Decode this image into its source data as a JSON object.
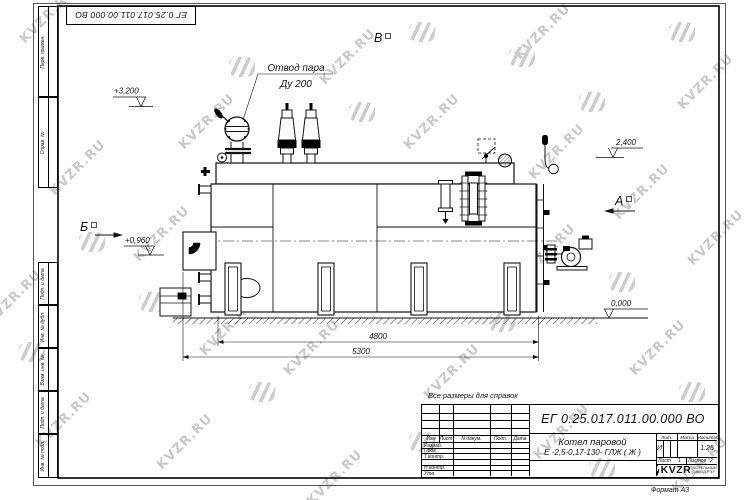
{
  "watermark": {
    "text": "KVZR.RU",
    "text_positions": [
      [
        48,
        16
      ],
      [
        78,
        168
      ],
      [
        14,
        298
      ],
      [
        64,
        420
      ],
      [
        162,
        234
      ],
      [
        207,
        122
      ],
      [
        228,
        328
      ],
      [
        185,
        442
      ],
      [
        302,
        202
      ],
      [
        312,
        348
      ],
      [
        348,
        57
      ],
      [
        335,
        478
      ],
      [
        432,
        122
      ],
      [
        418,
        257
      ],
      [
        452,
        372
      ],
      [
        543,
        32
      ],
      [
        557,
        152
      ],
      [
        548,
        252
      ],
      [
        562,
        432
      ],
      [
        642,
        192
      ],
      [
        658,
        348
      ],
      [
        706,
        82
      ],
      [
        716,
        238
      ],
      [
        700,
        465
      ]
    ],
    "logo_positions": [
      [
        92,
        242
      ],
      [
        32,
        352
      ],
      [
        152,
        302
      ],
      [
        242,
        67
      ],
      [
        217,
        257
      ],
      [
        362,
        112
      ],
      [
        302,
        292
      ],
      [
        422,
        32
      ],
      [
        472,
        202
      ],
      [
        502,
        322
      ],
      [
        422,
        442
      ],
      [
        592,
        102
      ],
      [
        622,
        282
      ],
      [
        682,
        32
      ],
      [
        692,
        392
      ],
      [
        602,
        468
      ],
      [
        262,
        392
      ],
      [
        522,
        57
      ]
    ]
  },
  "stamps": {
    "top_doc_number": "ЕГ 0.25.017.011.00.000  ВО",
    "left_top": [
      "Перв. примен.",
      "Справ. №"
    ],
    "left_bottom": [
      "Подп. и дата",
      "Инв. № дубл.",
      "Взам. инв. №",
      "Подп. и дата",
      "Инв. № подл."
    ]
  },
  "drawing": {
    "steam_label_line1": "Отвод пара",
    "steam_label_line2": "Ду 200",
    "elev_top": "+3,200",
    "elev_right_upper": "2,400",
    "elev_left": "+0,960",
    "elev_ground": "0,000",
    "view_top": "В",
    "view_right": "А",
    "view_left": "Б",
    "dim_inner": "4800",
    "dim_outer": "5300"
  },
  "titleblock": {
    "note": "Все размеры для справок",
    "doc_number": "ЕГ 0.25.017.011.00.000  ВО",
    "product_line1": "Котел паровой",
    "product_line2": "Е -2,5-0,17-130- ГЛЖ ( Ж )",
    "rev_header": [
      "Изм",
      "Лист",
      "N докум.",
      "Подп.",
      "Дата"
    ],
    "sign_rows": [
      "Разраб.",
      "Пров.",
      "Т.контр.",
      "",
      "Н.контр.",
      "Утв."
    ],
    "lit_label": "Лит.",
    "mass_label": "Масса",
    "scale_label": "Масштаб",
    "lit_value": "И",
    "scale_value": "1:25",
    "sheet_label": "Лист",
    "sheet_value": "1",
    "sheets_label": "Листов",
    "sheets_value": "2",
    "company_name": "KVZR",
    "company_sub1": "КОТЕЛЬНЫЙ",
    "company_sub2": "ЗАВОД РЭУ",
    "format_note": "Формат А3"
  }
}
